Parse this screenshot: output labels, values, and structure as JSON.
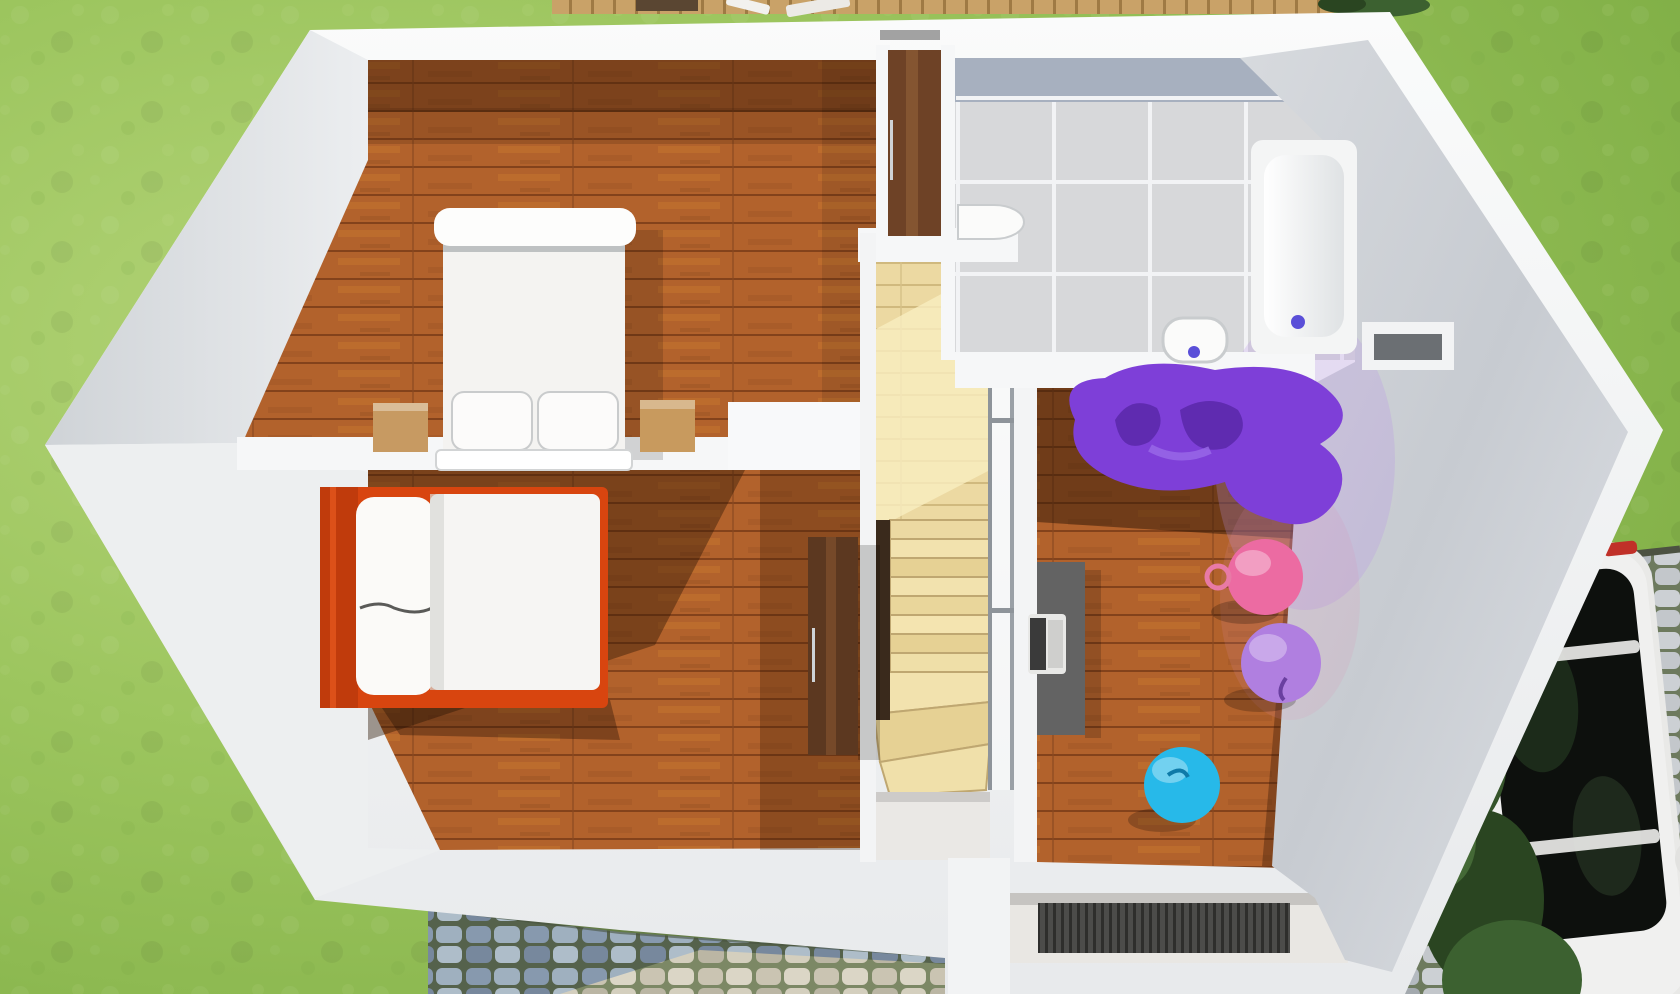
{
  "scene": {
    "type": "3d-floor-plan-render",
    "view": "top-down dollhouse view of upper storey",
    "rooms": [
      {
        "id": "bedroom-main",
        "contents": [
          "double-bed",
          "pillow",
          "pillow",
          "nightstand-left",
          "nightstand-right",
          "chest",
          "wardrobe"
        ]
      },
      {
        "id": "bedroom-single",
        "contents": [
          "single-bed-red-frame",
          "pillow",
          "duvet",
          "tall-dresser"
        ]
      },
      {
        "id": "stair-hall",
        "contents": [
          "landing",
          "straight-stairs",
          "winder-stairs",
          "glass-railing"
        ]
      },
      {
        "id": "bathroom",
        "contents": [
          "wash-basin",
          "toilet",
          "bathtub",
          "wall-niche"
        ]
      },
      {
        "id": "playroom",
        "contents": [
          "desk",
          "laptop",
          "bean-bag-chair",
          "hopper-ball-pink",
          "ball-lilac",
          "ball-blue"
        ]
      },
      {
        "id": "entry-porch",
        "contents": [
          "doormat"
        ]
      }
    ],
    "exterior": [
      "lawn",
      "wood-deck",
      "deck-furniture",
      "cobblestone-path",
      "cobblestone-driveway",
      "white-car",
      "shrubs"
    ]
  },
  "colors": {
    "grass": "#96c157",
    "grassLight": "#b3d377",
    "wallWhite": "#f4f5f6",
    "wallFace": "#d5d8dc",
    "wallFaceLight": "#edeff0",
    "woodFloor": "#b2622c",
    "woodShadow": "#2e1505",
    "stairWood": "#ecd9a2",
    "stairSun": "#f9eec0",
    "stairVoid": "#3a2a1c",
    "tile": "#d7d8da",
    "tileBand": "#a7b0bf",
    "grout": "#f2f3f5",
    "fixtureWhite": "#fbfbfa",
    "drainBlue": "#5a4fd8",
    "bedWhite": "#f4f3f1",
    "bedFrameRed": "#d8450f",
    "headboardRed": "#c03b0c",
    "nightstand": "#c79a62",
    "wardrobe": "#6e4226",
    "dresser": "#5c3820",
    "beanbag": "#7e3fd8",
    "beanbagFold": "#5f2bb0",
    "ballPink": "#ec6ba2",
    "ballLilac": "#b07fe0",
    "ballBlue": "#27b9e9",
    "desk": "#636363",
    "laptop": "#e8e8e6",
    "doormat": "#4c4c4a",
    "porchFloor": "#e9e7e3",
    "carBody": "#e9e9e7",
    "carGlass": "#0d100d",
    "tailLight": "#c03028",
    "cobbleGroutPath": "#55624c",
    "cobbleBlue": "#8799ae",
    "cobbleBeige": "#cdc6b2",
    "driveStone": "#bcc1c6",
    "deckWood": "#c9a268",
    "shrub": "#35542a"
  }
}
